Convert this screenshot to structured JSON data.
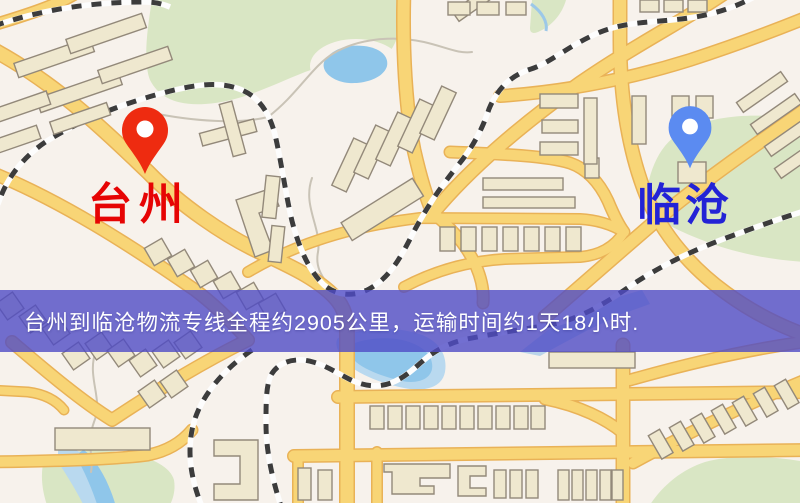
{
  "banner": {
    "text": "台州到临沧物流专线全程约2905公里，运输时间约1天18小时.",
    "distance": "2905公里",
    "duration": "1天18小时"
  },
  "markers": {
    "origin": {
      "label": "台州",
      "icon": "map-pin-icon"
    },
    "destination": {
      "label": "临沧",
      "icon": "map-pin-icon"
    }
  },
  "colors": {
    "background": "#f7f2ec",
    "road": "#f8d576",
    "park": "#d9e6c4",
    "water": "#8fc6ea",
    "railway": "#3c3c3c",
    "origin_pin": "#ee2b10",
    "destination_pin": "#5b8bf1",
    "origin_label": "#e60404",
    "destination_label": "#2323d6",
    "banner_bg": "#4f4bc6",
    "banner_text": "#ffffff"
  }
}
